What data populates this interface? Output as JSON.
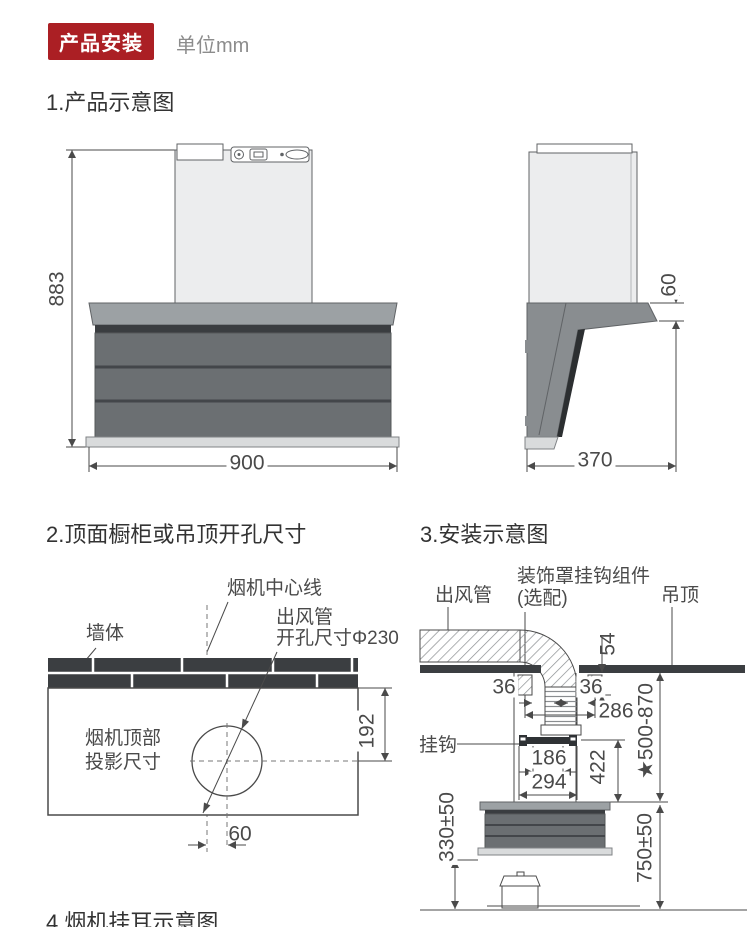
{
  "header": {
    "badge": "产品安装",
    "unit": "单位mm"
  },
  "s1": {
    "title": "1.产品示意图",
    "front": {
      "height_mm": "883",
      "width_mm": "900"
    },
    "side": {
      "flue_height_mm": "60",
      "depth_mm": "370"
    }
  },
  "s2": {
    "title": "2.顶面橱柜或吊顶开孔尺寸",
    "centerline_label": "烟机中心线",
    "wall_label": "墙体",
    "duct_label_1": "出风管",
    "duct_label_2": "开孔尺寸Φ230",
    "projection_label_1": "烟机顶部",
    "projection_label_2": "投影尺寸",
    "dim_vertical": "192",
    "dim_horizontal": "60"
  },
  "s3": {
    "title": "3.安装示意图",
    "duct_label": "出风管",
    "decor_label_1": "装饰罩挂钩组件",
    "decor_label_2": "(选配)",
    "ceiling_label": "吊顶",
    "hook_label": "挂钩",
    "dim_ceiling_gap": "54",
    "dim_36_left": "36",
    "dim_36_right": "36",
    "dim_span": "286",
    "dim_hook_holes": "186",
    "dim_hook_width": "294",
    "dim_cover_height": "422",
    "dim_ceiling_to_hood": "★500-870",
    "dim_hood_bottom": "330±50",
    "dim_hood_top_to_counter": "750±50"
  },
  "s4": {
    "title": "4.烟机挂耳示意图"
  },
  "colors": {
    "badge_red": "#ab1f24",
    "line": "#4a4a4a",
    "body_gray": "#6b6f72",
    "band_gray": "#9ca1a4",
    "dark_trim": "#3a3d40",
    "light_trim": "#d9dbdc",
    "panel_light": "#ecedee",
    "brick_dark": "#3b3e41"
  }
}
